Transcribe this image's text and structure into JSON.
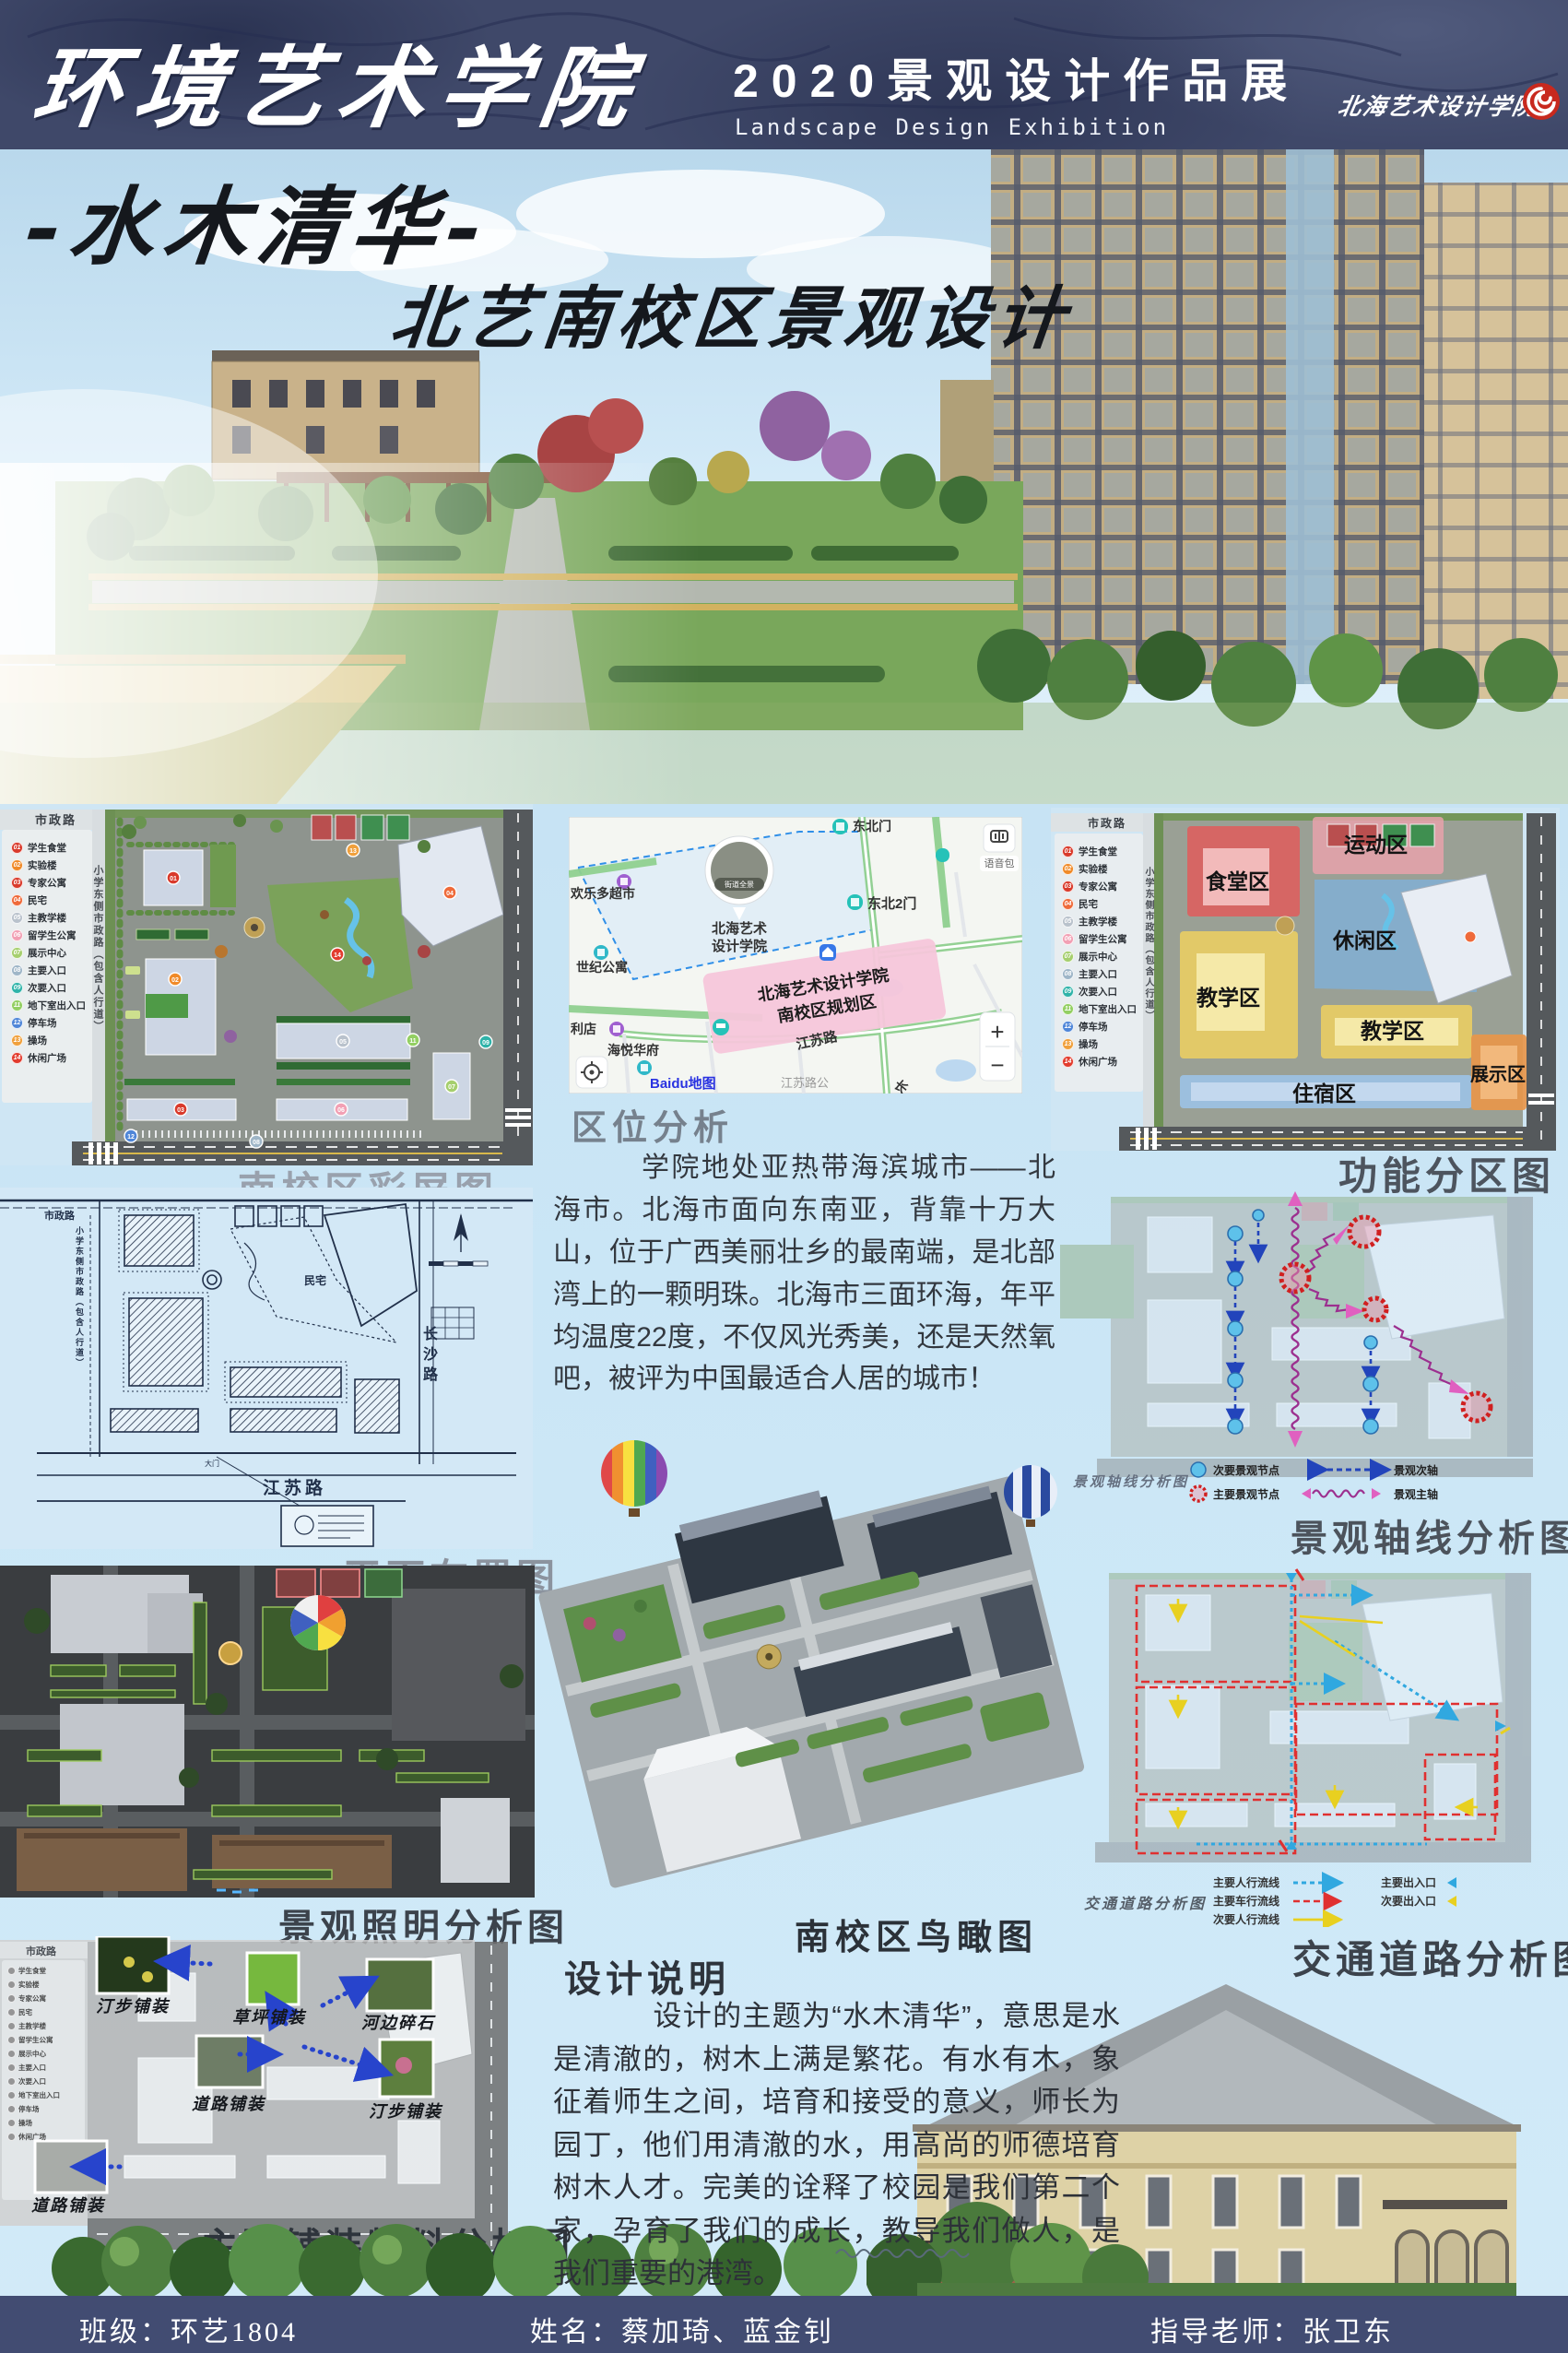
{
  "header": {
    "school_title": "环境艺术学院",
    "exhibition_title": "2020景观设计作品展",
    "exhibition_subtitle": "Landscape Design Exhibition",
    "logo_text": "北海艺术设计学院"
  },
  "hero": {
    "main_title": "-水木清华-",
    "sub_title": "北艺南校区景观设计"
  },
  "legend": {
    "items": [
      {
        "num": "01",
        "label": "学生食堂",
        "color": "#d93a2b"
      },
      {
        "num": "02",
        "label": "实验楼",
        "color": "#f08a28"
      },
      {
        "num": "03",
        "label": "专家公寓",
        "color": "#d93a2b"
      },
      {
        "num": "04",
        "label": "民宅",
        "color": "#ef6a3a"
      },
      {
        "num": "05",
        "label": "主教学楼",
        "color": "#b9c2cc"
      },
      {
        "num": "06",
        "label": "留学生公寓",
        "color": "#f2a0b4"
      },
      {
        "num": "07",
        "label": "展示中心",
        "color": "#a6cf6e"
      },
      {
        "num": "08",
        "label": "主要入口",
        "color": "#9fb6c8"
      },
      {
        "num": "09",
        "label": "次要入口",
        "color": "#2fb3a9"
      },
      {
        "num": "11",
        "label": "地下室出入口",
        "color": "#93cf62"
      },
      {
        "num": "12",
        "label": "停车场",
        "color": "#4f86d8"
      },
      {
        "num": "13",
        "label": "操场",
        "color": "#f0a03c"
      },
      {
        "num": "14",
        "label": "休闲广场",
        "color": "#e23c2e"
      }
    ]
  },
  "roads": {
    "municipal": "市政路",
    "school_side": "小学东侧市政路（包含人行道）",
    "changsha": "长沙路",
    "jiangsu": "江苏路",
    "residence": "民宅",
    "gate": "大门"
  },
  "map": {
    "ne_gate": "东北门",
    "ne_gate2": "东北2门",
    "college_line1": "北海艺术",
    "college_line2": "设计学院",
    "street_view": "街道全景",
    "supermarket": "欢乐多超市",
    "apartment": "世纪公寓",
    "store": "利店",
    "estate": "海悦华府",
    "planning_line1": "北海艺术设计学院",
    "planning_line2": "南校区规划区",
    "jiangsu_road": "江苏路",
    "bus_stop": "江苏路公",
    "chang": "长",
    "voice_pack": "语音包",
    "zoom_in": "+",
    "zoom_out": "−",
    "baidu_logo": "Baidu地图"
  },
  "sections": {
    "master_plan_caption": "南校区彩屏图",
    "location_heading": "区位分析",
    "location_body": "学院地处亚热带海滨城市——北海市。北海市面向东南亚，背靠十万大山，位于广西美丽壮乡的最南端，是北部湾上的一颗明珠。北海市三面环海，年平均温度22度，不仅风光秀美，还是天然氧吧，被评为中国最适合人居的城市！",
    "function_caption": "功能分区图",
    "zones": {
      "canteen": "食堂区",
      "sports": "运动区",
      "leisure": "休闲区",
      "teaching": "教学区",
      "dorm": "住宿区",
      "exhibition": "展示区"
    },
    "layout_caption": "平面布置图",
    "axis_caption": "景观轴线分析图",
    "axis_inner_label": "景观轴线分析图",
    "axis_legend": {
      "secondary_node": "次要景观节点",
      "main_node": "主要景观节点",
      "secondary_axis": "景观次轴",
      "main_axis": "景观主轴"
    },
    "birdseye_caption": "南校区鸟瞰图",
    "lighting_caption": "景观照明分析图",
    "traffic_caption": "交通道路分析图",
    "traffic_inner_label": "交通道路分析图",
    "traffic_legend": {
      "ped_main": "主要人行流线",
      "veh_main": "主要车行流线",
      "ped_secondary": "次要人行流线",
      "entry_main": "主要出入口",
      "entry_secondary": "次要出入口"
    },
    "pavement_caption": "主要铺装物料分析图",
    "pavement_labels": {
      "stepping1": "汀步铺装",
      "lawn": "草坪铺装",
      "river_stone": "河边碎石",
      "road1": "道路铺装",
      "stepping2": "汀步铺装",
      "road2": "道路铺装"
    },
    "design_heading": "设计说明",
    "design_body": "设计的主题为“水木清华”，意思是水是清澈的，树木上满是繁花。有水有木，象征着师生之间，培育和接受的意义，师长为园丁，他们用清澈的水，用高尚的师德培育树木人才。完美的诠释了校园是我们第二个家，孕育了我们的成长，教导我们做人，是我们重要的港湾。"
  },
  "footer": {
    "class_label": "班级：环艺1804",
    "name_label": "姓名：蔡加琦、蓝金钊",
    "teacher_label": "指导老师：张卫东"
  },
  "colors": {
    "header_bg": "#3f4869",
    "footer_bg": "#424c72",
    "page_bg": "#cde7f7",
    "accent_red": "#c8291e",
    "caption_light": "#99a1ad",
    "caption_dark": "#3c434c"
  }
}
